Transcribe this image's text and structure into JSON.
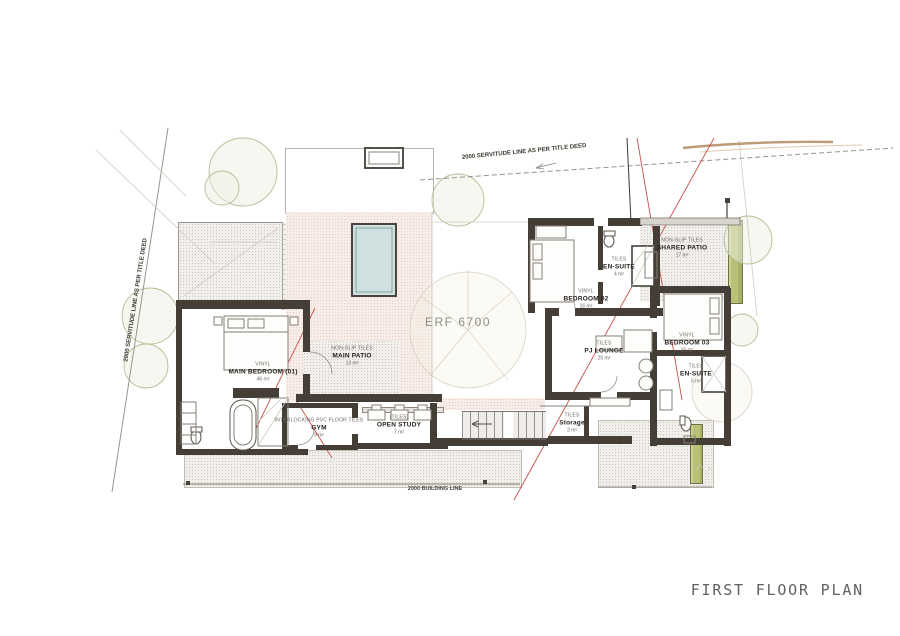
{
  "sheet": {
    "title": "FIRST FLOOR PLAN",
    "erf_label": "ERF 6700"
  },
  "site_annotations": {
    "servitude_top": "2000 SERVITUDE LINE AS PER TITLE DEED",
    "servitude_left": "2000 SERVITUDE LINE AS PER TITLE DEED",
    "building_line": "2000 BUILDING LINE"
  },
  "rooms": [
    {
      "id": "main-bedroom",
      "finish": "VINYL",
      "name": "MAIN BEDROOM (01)",
      "area": "46 m²"
    },
    {
      "id": "main-patio",
      "finish": "NON-SLIP TILES",
      "name": "MAIN PATIO",
      "area": "13 m²"
    },
    {
      "id": "gym",
      "finish": "INTERLOCKING PVC FLOOR TILES",
      "name": "GYM",
      "area": "9 m²"
    },
    {
      "id": "open-study",
      "finish": "(TILES)",
      "name": "OPEN STUDY",
      "area": "7 m²"
    },
    {
      "id": "bedroom-02",
      "finish": "VINYL",
      "name": "BEDROOM 02",
      "area": "16 m²"
    },
    {
      "id": "ensuite-02",
      "finish": "TILES",
      "name": "EN-SUITE",
      "area": "4 m²"
    },
    {
      "id": "shared-patio",
      "finish": "NON-SLIP TILES",
      "name": "SHARED PATIO",
      "area": "17 m²"
    },
    {
      "id": "bedroom-03",
      "finish": "VINYL",
      "name": "BEDROOM 03",
      "area": "15 m²"
    },
    {
      "id": "pj-lounge",
      "finish": "TILES",
      "name": "PJ LOUNGE",
      "area": "20 m²"
    },
    {
      "id": "ensuite-03",
      "finish": "TILES",
      "name": "EN-SUITE",
      "area": "5 m²"
    },
    {
      "id": "storage",
      "finish": "TILES",
      "name": "Storage",
      "area": "3 m²"
    }
  ],
  "colors": {
    "wall": "#453e37",
    "red_survey_line": "#c4524a",
    "pool_water": "#cfe0e1",
    "planter_green": "#b9c178",
    "patio_fill": "#f7ece7",
    "title_text": "#606065"
  }
}
